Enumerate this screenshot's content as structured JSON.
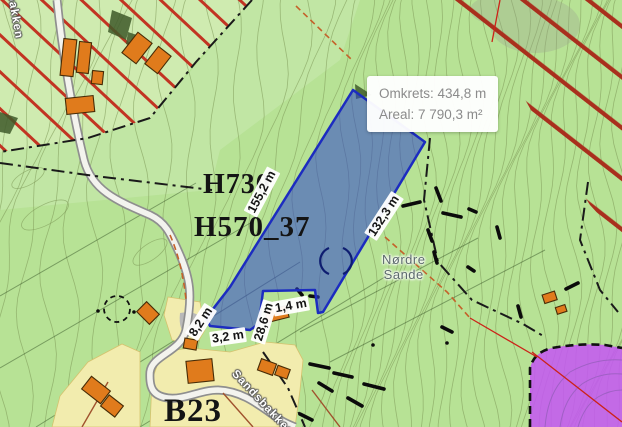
{
  "tooltip": {
    "perimeter": "Omkrets: 434,8 m",
    "area": "Areal: 7 790,3 m²"
  },
  "measurements": {
    "left_edge": "155,2 m",
    "right_edge": "132,3 m",
    "notch_left": "28,6 m",
    "notch_top": "1,4 m",
    "road_cross": "8,2 m",
    "road_gap": "3,2 m"
  },
  "zone_labels": {
    "hazard_zone": "H730",
    "heritage_zone": "H570_37",
    "housing_zone": "B23"
  },
  "place_labels": {
    "farm_name_line1": "Nørdre",
    "farm_name_line2": "Sande",
    "road_name_bottom": "Sandsbakken",
    "road_name_top_left": "Sandsbakken"
  },
  "colors": {
    "map_green": "#b7e295",
    "measure_fill": "#2e46cc",
    "measure_stroke": "#1c2cc0",
    "hatch_red": "#c23422",
    "purple_zone": "#c457f2",
    "building_orange": "#e07b1c",
    "yellow_zone": "#f2ecae",
    "tooltip_text": "#8b8b8b"
  }
}
